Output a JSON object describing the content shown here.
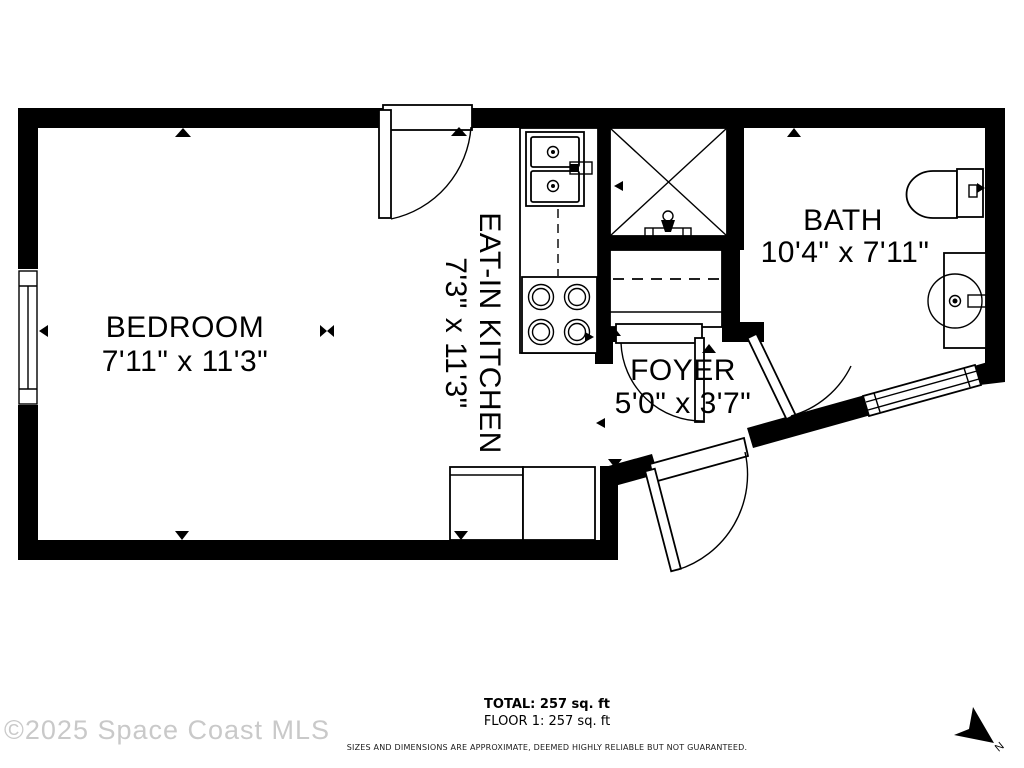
{
  "rooms": {
    "bedroom": {
      "name": "BEDROOM",
      "dims": "7'11\" x 11'3\""
    },
    "kitchen": {
      "name": "EAT-IN KITCHEN",
      "dims": "7'3\" x 11'3\""
    },
    "bath": {
      "name": "BATH",
      "dims": "10'4\" x 7'11\""
    },
    "foyer": {
      "name": "FOYER",
      "dims": "5'0\" x 3'7\""
    }
  },
  "footer": {
    "total": "TOTAL: 257 sq. ft",
    "floor": "FLOOR 1: 257 sq. ft",
    "disclaimer": "SIZES AND DIMENSIONS ARE APPROXIMATE, DEEMED HIGHLY RELIABLE BUT NOT GUARANTEED."
  },
  "watermark": "©2025 Space Coast MLS",
  "compass": {
    "label": "N"
  },
  "colors": {
    "wall": "#000000",
    "background": "#ffffff",
    "watermark": "#c9c9c9"
  }
}
